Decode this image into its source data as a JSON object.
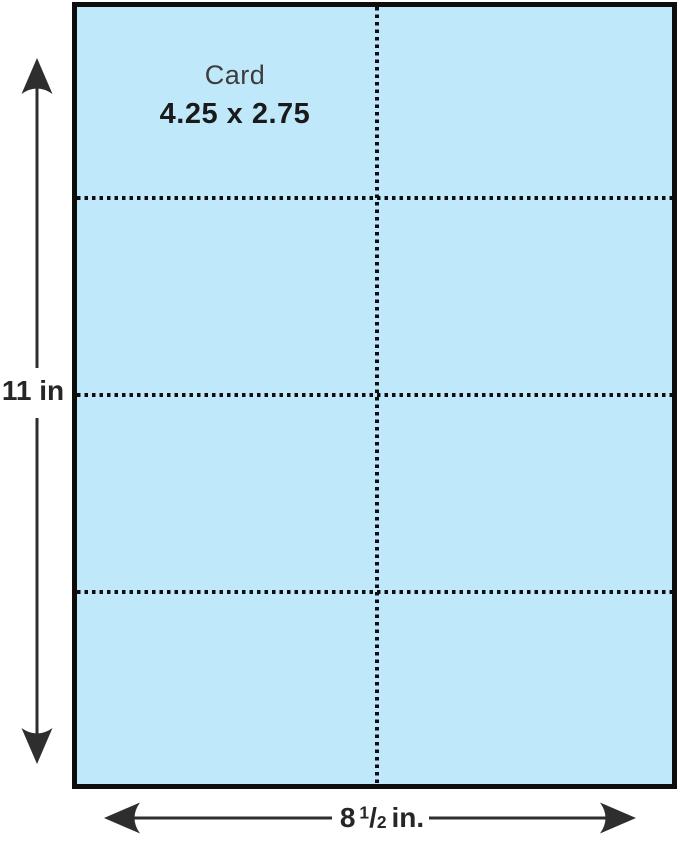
{
  "colors": {
    "page_bg": "#ffffff",
    "sheet_fill": "#bfe9fb",
    "line": "#0d0d0d",
    "dim": "#2e2e2e",
    "text": "#1a1a1a"
  },
  "sheet": {
    "rows": 4,
    "columns": 2,
    "card": {
      "name": "Card",
      "size": "4.25 x 2.75"
    }
  },
  "dimensions": {
    "height": {
      "label": "11 in"
    },
    "width": {
      "whole": "8",
      "numerator": "1",
      "separator": "/",
      "denominator": "2",
      "unit": "in."
    }
  }
}
